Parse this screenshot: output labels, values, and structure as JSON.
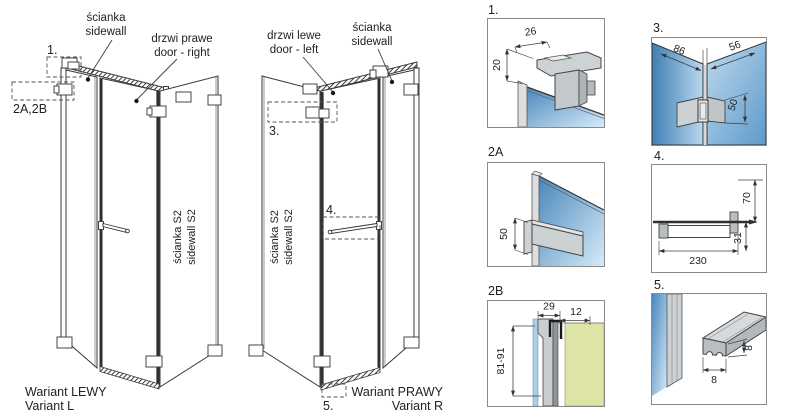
{
  "colors": {
    "glass_dark": "#4a87bb",
    "glass_light": "#d5eaf8",
    "glass_flat": "#a9cfe5",
    "metal": "#ccd1d4",
    "wall_green": "#dde4a6",
    "line": "#3a3a3a"
  },
  "views": {
    "left": {
      "sidewall_label": [
        "ścianka",
        "sidewall"
      ],
      "door_label": [
        "drzwi prawe",
        "door - right"
      ],
      "s2_label": [
        "ścianka S2",
        "sidewall S2"
      ],
      "callout_1": "1.",
      "callout_2ab": "2A,2B",
      "variant": [
        "Wariant LEWY",
        "Variant L"
      ]
    },
    "right": {
      "door_label": [
        "drzwi lewe",
        "door - left"
      ],
      "sidewall_label": [
        "ścianka",
        "sidewall"
      ],
      "s2_label": [
        "ścianka S2",
        "sidewall S2"
      ],
      "callout_3": "3.",
      "callout_4": "4.",
      "callout_5": "5.",
      "variant": [
        "Wariant PRAWY",
        "Variant R"
      ]
    }
  },
  "details": {
    "d1": {
      "label": "1.",
      "dim_width": "26",
      "dim_height": "20"
    },
    "d2a": {
      "label": "2A",
      "dim_height": "50"
    },
    "d2b": {
      "label": "2B",
      "dim_a": "29",
      "dim_b": "12",
      "dim_range": "81-91"
    },
    "d3": {
      "label": "3.",
      "dim_left": "86",
      "dim_right": "56",
      "dim_height": "50"
    },
    "d4": {
      "label": "4.",
      "dim_length": "230",
      "dim_height": "70",
      "dim_offset": "31"
    },
    "d5": {
      "label": "5.",
      "dim_width": "8",
      "dim_height": "8"
    }
  }
}
